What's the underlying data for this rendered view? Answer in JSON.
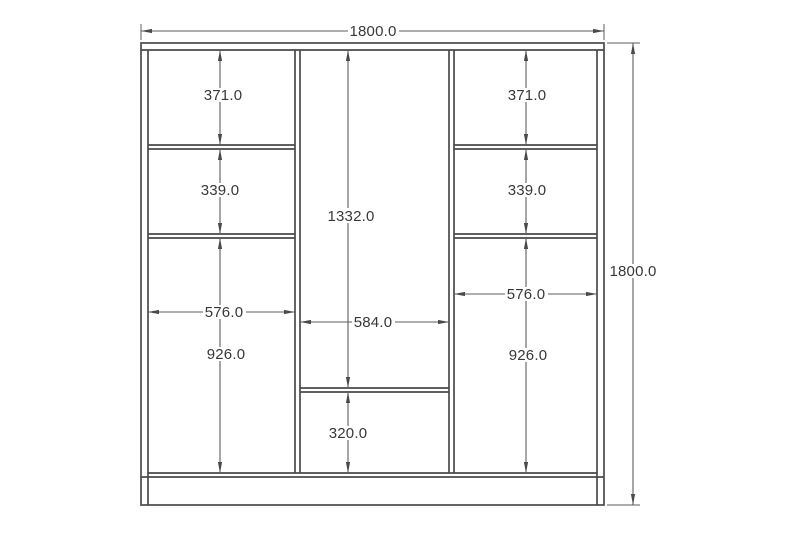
{
  "drawing": {
    "overall": {
      "width": "1800.0",
      "height": "1800.0"
    },
    "left_section": {
      "top_compartment_height": "371.0",
      "middle_compartment_height": "339.0",
      "lower_compartment_height": "926.0",
      "inner_width": "576.0"
    },
    "center_section": {
      "upper_compartment_height": "1332.0",
      "inner_width": "584.0",
      "lower_compartment_height": "320.0"
    },
    "right_section": {
      "top_compartment_height": "371.0",
      "middle_compartment_height": "339.0",
      "lower_compartment_height": "926.0",
      "inner_width": "576.0"
    }
  }
}
